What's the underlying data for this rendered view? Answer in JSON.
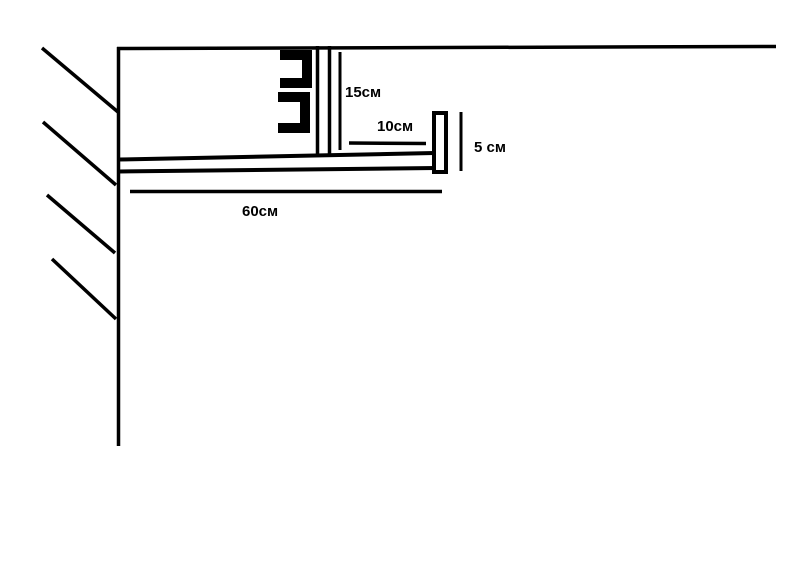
{
  "page": {
    "background": "#ffffff",
    "ink": "#000000",
    "description": "Hand-drawn cross-section sketch of a ceiling curtain niche with a wall, hatching, mounting bracket and dimension callouts"
  },
  "diagram": {
    "labels": {
      "channel_height": "15см",
      "ledge_offset": "10см",
      "lip_height": "5 см",
      "shelf_length": "60см"
    }
  }
}
